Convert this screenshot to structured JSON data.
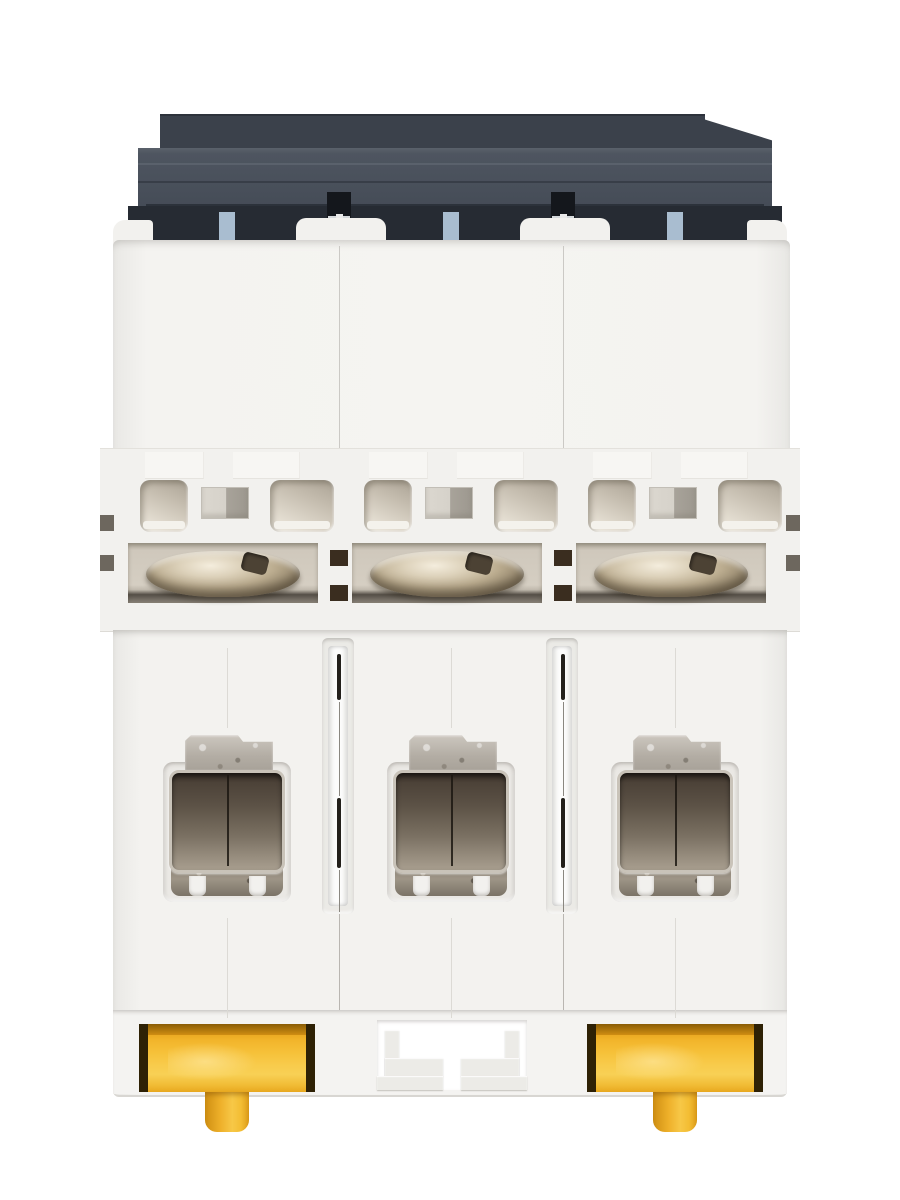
{
  "meta": {
    "description": "Product photograph of a 3-pole DIN-rail miniature circuit breaker (MCB) seen from the bottom terminal side on a white background",
    "visible_text": ""
  },
  "device": {
    "name": "3-pole miniature circuit breaker",
    "view": "bottom terminal view",
    "pole_count": 3,
    "pole_labels": [
      "pole-1",
      "pole-2",
      "pole-3"
    ],
    "parts": {
      "top_housing": "dark charcoal switch housing",
      "terminal_screws": "nickel slotted terminal screws",
      "terminal_openings": "wire clamp cages",
      "din_clips": [
        "din-rail-clip-left",
        "din-rail-clip-right"
      ],
      "center_slot": "fixed din-rail slot on middle pole"
    }
  },
  "colors": {
    "bg": "#ffffff",
    "charcoalDark": "#3b414b",
    "charcoalMid": "#383e48",
    "notchDark": "#262b33",
    "blueTab": "#a9bdd0",
    "housingWhite": "#f3f2ef",
    "beige": "#d5cec2",
    "screwMetal": "#bcad90",
    "terminalDark": "#4c4238",
    "terminalLight": "#a89e8f",
    "lipMetal": "#8d8477",
    "clipYellow": "#f6c139",
    "clipYellowLight": "#f8d055",
    "clipYellowDark": "#cf8d12",
    "clipBorder": "#2e2105"
  }
}
